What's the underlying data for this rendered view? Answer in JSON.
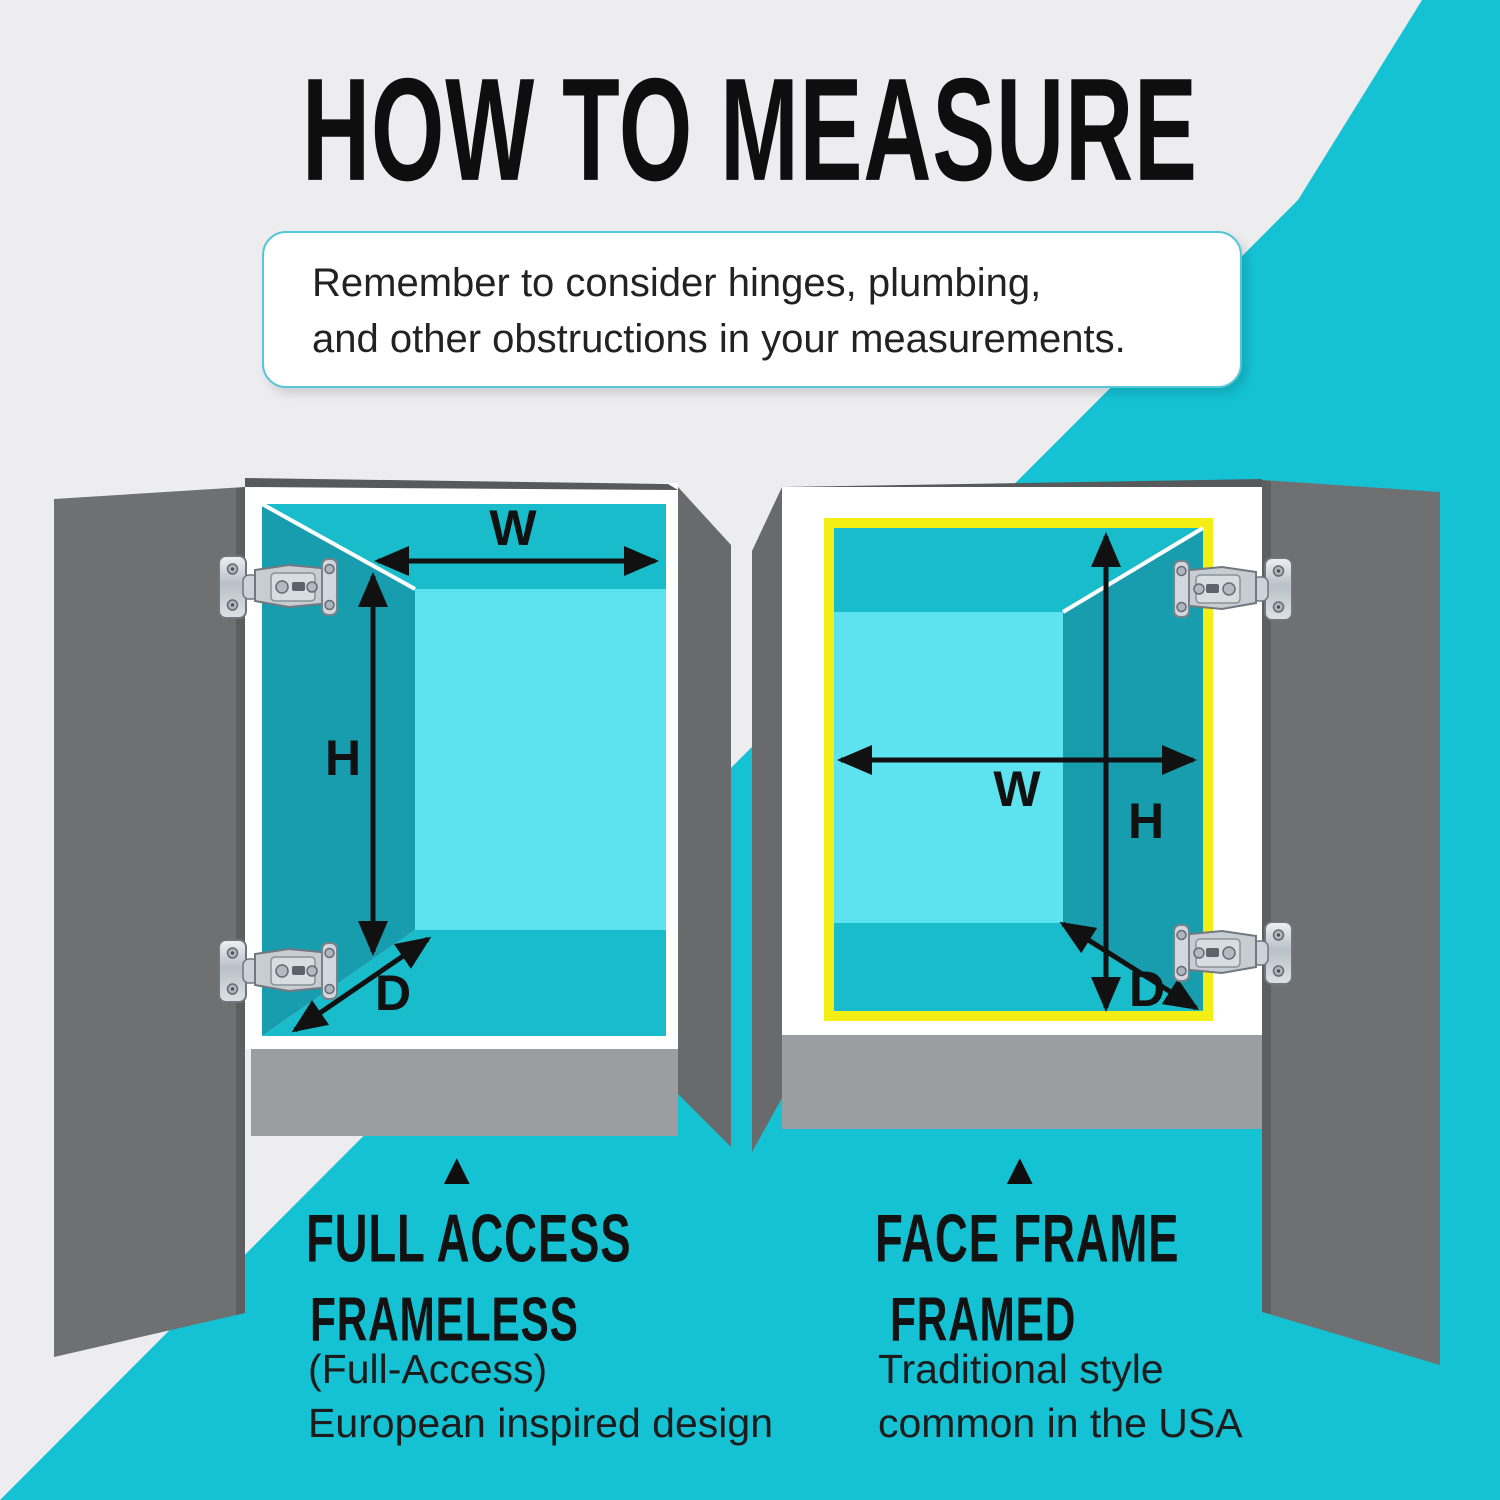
{
  "title": "HOW TO MEASURE",
  "note": {
    "line1": "Remember to consider hinges, plumbing,",
    "line2": "and other obstructions in your measurements."
  },
  "dimension_labels": {
    "width": "W",
    "height": "H",
    "depth": "D"
  },
  "legend": {
    "left": {
      "pointer": "▲",
      "heading": "FULL ACCESS",
      "subheading": "FRAMELESS",
      "detail_line1": "(Full-Access)",
      "detail_line2": "European inspired design"
    },
    "right": {
      "pointer": "▲",
      "heading": "FACE FRAME",
      "subheading": "FRAMED",
      "detail_line1": "Traditional style",
      "detail_line2": "common in the USA"
    }
  },
  "colors": {
    "background_gray": "#ededef",
    "accent_teal": "#14c2d4",
    "interior_wall_teal": "#19bcca",
    "interior_back_cyan": "#5ce3ef",
    "interior_side_teal": "#189dae",
    "door_gray": "#6f7072",
    "side_panel_gray": "#696a6c",
    "base_gray": "#9c9da0",
    "face_frame_yellow": "#f3ee14",
    "arrow_black": "#111111",
    "note_border_cyan": "#55c7d7"
  }
}
